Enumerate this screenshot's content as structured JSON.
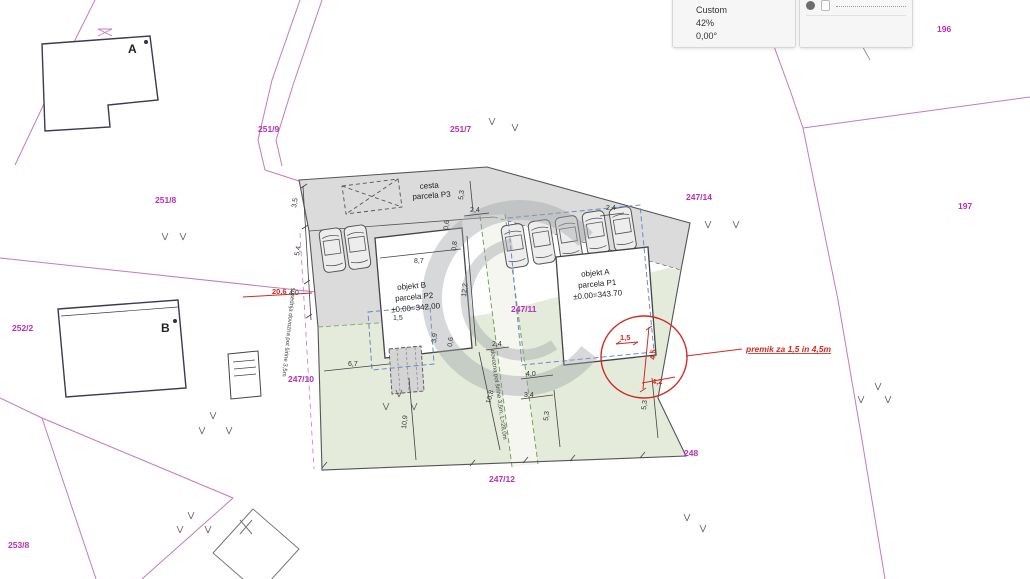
{
  "palette": {
    "scale_label": "Custom",
    "zoom_label": "42%",
    "angle_label": "0,00°",
    "trace_header": "ACTIVE:"
  },
  "parcels": [
    {
      "label": "251/9"
    },
    {
      "label": "251/7"
    },
    {
      "label": "251/8"
    },
    {
      "label": "247/14"
    },
    {
      "label": "197"
    },
    {
      "label": "196"
    },
    {
      "label": "252/2"
    },
    {
      "label": "247/10"
    },
    {
      "label": "247/11"
    },
    {
      "label": "247/12"
    },
    {
      "label": "248"
    },
    {
      "label": "253/8"
    }
  ],
  "plan": {
    "road_label_1": "cesta",
    "road_label_2": "parcela P3",
    "objekt_b_1": "objekt B",
    "objekt_b_2": "parcela P2",
    "objekt_b_3": "±0.00=342.00",
    "objekt_a_1": "objekt A",
    "objekt_a_2": "parcela P1",
    "objekt_a_3": "±0.00=343.70",
    "left_road_note": "sosednja dovozna pot širine 3,5m",
    "central_road_note": "dovozna pot širine 3,5m, L=28,0m",
    "building_a_letter": "A",
    "building_b_letter": "B"
  },
  "dims": {
    "d35": "3,5",
    "d54": "5,4",
    "d40l": "4,0",
    "d87": "8,7",
    "d122": "12,2",
    "d53t": "5,3",
    "d24t": "2,4",
    "d24r": "2,4",
    "d06t": "0,6",
    "d08": "0,8",
    "d15": "1,5",
    "d39": "3,9",
    "d24m": "2,4",
    "d06m": "0,6",
    "d67": "6,7",
    "d109": "10,9",
    "d108": "10,8",
    "d40a": "4,0",
    "d34": "3,4",
    "d53l": "5,3",
    "d53r": "5,3"
  },
  "red": {
    "r206": "20,6",
    "r15": "1,5",
    "r45": "4,5",
    "r42": "4,2",
    "note": "premik za 1,5 in 4,5m"
  },
  "colors": {
    "parcel_label": "#b62fb6",
    "cadastral_line": "#c478c4",
    "red_annotation": "#cf2b24",
    "road_fill": "#dbdbdb",
    "green_fill": "#e4ebda",
    "dashed_blue": "#6f86c8",
    "dashed_green": "#79a25e",
    "watermark": "#9fa4a8"
  }
}
